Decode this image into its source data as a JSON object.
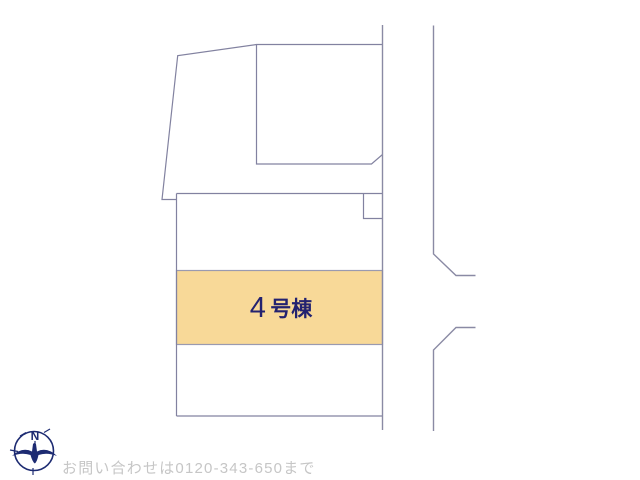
{
  "plan": {
    "highlighted_lot": {
      "label_number": "4",
      "label_suffix": "号棟"
    },
    "compass": {
      "north_label": "N"
    },
    "footer": {
      "contact_text": "お問い合わせは0120-343-650まで"
    },
    "colors": {
      "highlight_fill": "#f8d998",
      "boundary_line": "#8282a0",
      "lot_label_text": "#232270",
      "compass_navy": "#1d2b72",
      "footer_text": "#c6c6c6"
    }
  }
}
